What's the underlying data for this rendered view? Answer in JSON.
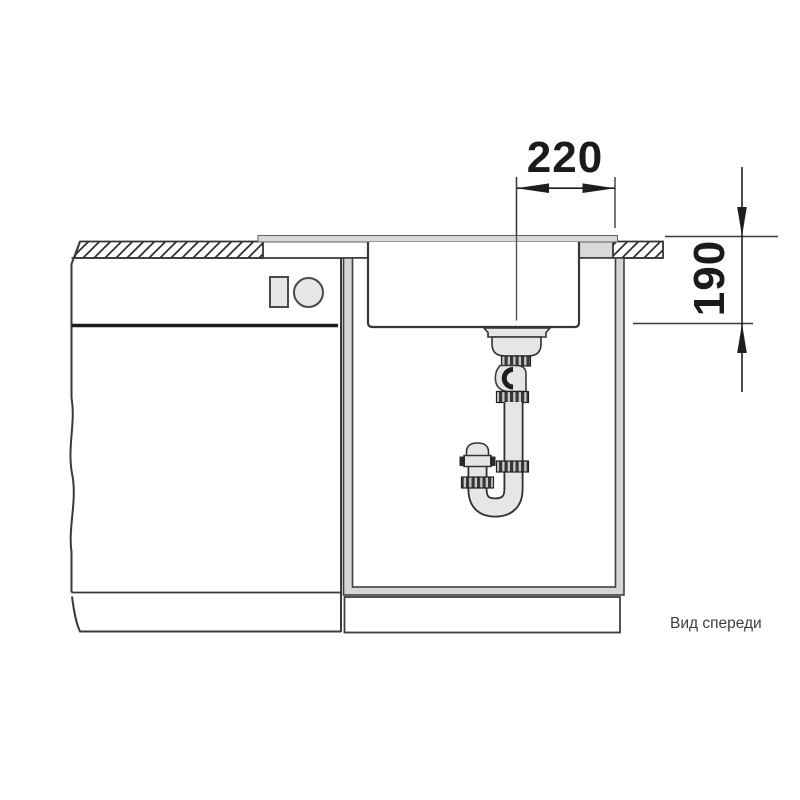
{
  "drawing": {
    "caption": "Вид спереди",
    "dim_width": {
      "value": "220"
    },
    "dim_depth": {
      "value": "190"
    },
    "colors": {
      "line": "#3a3a3a",
      "line_dark": "#1e1e1e",
      "fill_light": "#e6e6e6",
      "fill_gray": "#d9d9d9",
      "frame_gray": "#d6d6d6",
      "background": "#ffffff"
    }
  }
}
